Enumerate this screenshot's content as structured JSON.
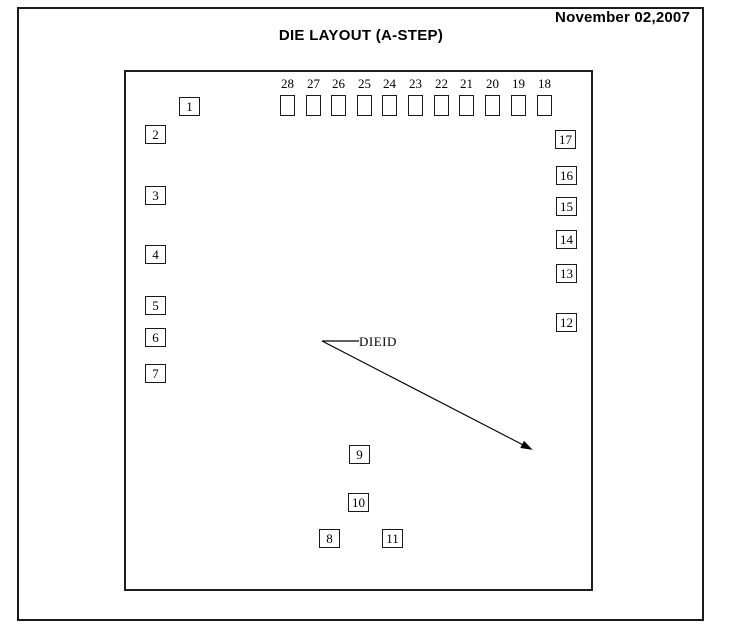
{
  "header": {
    "date": "November 02,2007",
    "title": "DIE LAYOUT (A-STEP)"
  },
  "die": {
    "dieid_label": "DIEID",
    "top_pad_row": {
      "square_w": 15,
      "square_h": 21,
      "pads": [
        {
          "label": "28",
          "x": 280
        },
        {
          "label": "27",
          "x": 306
        },
        {
          "label": "26",
          "x": 331
        },
        {
          "label": "25",
          "x": 357
        },
        {
          "label": "24",
          "x": 382
        },
        {
          "label": "23",
          "x": 408
        },
        {
          "label": "22",
          "x": 434
        },
        {
          "label": "21",
          "x": 459
        },
        {
          "label": "20",
          "x": 485
        },
        {
          "label": "19",
          "x": 511
        },
        {
          "label": "18",
          "x": 537
        }
      ]
    },
    "numbered_pads": [
      {
        "label": "1",
        "x": 179,
        "y": 97
      },
      {
        "label": "2",
        "x": 145,
        "y": 125
      },
      {
        "label": "3",
        "x": 145,
        "y": 186
      },
      {
        "label": "4",
        "x": 145,
        "y": 245
      },
      {
        "label": "5",
        "x": 145,
        "y": 296
      },
      {
        "label": "6",
        "x": 145,
        "y": 328
      },
      {
        "label": "7",
        "x": 145,
        "y": 364
      },
      {
        "label": "8",
        "x": 319,
        "y": 529
      },
      {
        "label": "9",
        "x": 349,
        "y": 445
      },
      {
        "label": "10",
        "x": 348,
        "y": 493
      },
      {
        "label": "11",
        "x": 382,
        "y": 529
      },
      {
        "label": "12",
        "x": 556,
        "y": 313
      },
      {
        "label": "13",
        "x": 556,
        "y": 264
      },
      {
        "label": "14",
        "x": 556,
        "y": 230
      },
      {
        "label": "15",
        "x": 556,
        "y": 197
      },
      {
        "label": "16",
        "x": 556,
        "y": 166
      },
      {
        "label": "17",
        "x": 555,
        "y": 130
      }
    ],
    "dieid_arrow": {
      "vertex": [
        322,
        341
      ],
      "leader_end": [
        359,
        341
      ],
      "tip": [
        531,
        449
      ]
    }
  },
  "colors": {
    "ink": "#000000",
    "background": "#ffffff"
  }
}
